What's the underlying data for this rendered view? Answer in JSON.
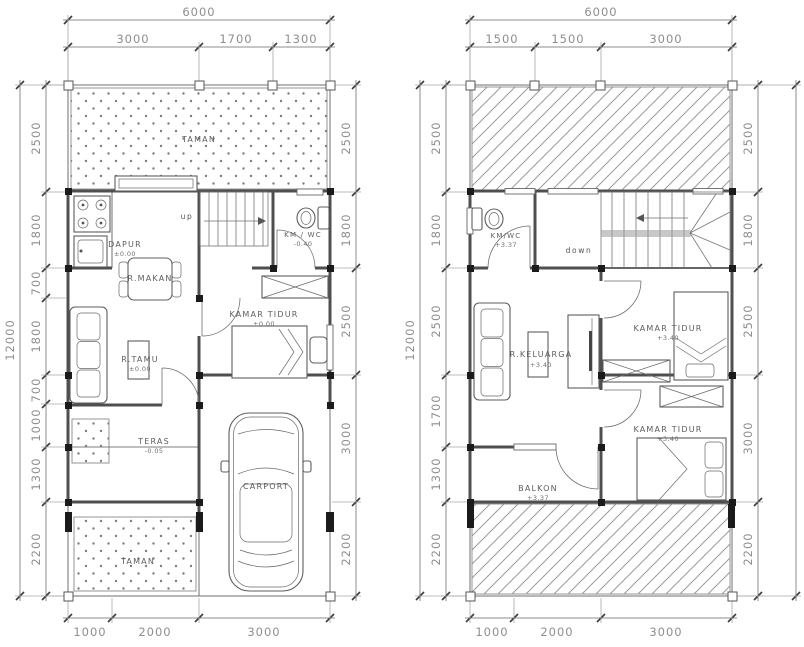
{
  "drawing": {
    "background": "#ffffff",
    "wall_color": "#4f4f4f",
    "dim_text_color": "#8e8e8e",
    "hatch_color": "#9b9b9b",
    "dot_color": "#7d7d7d",
    "column_color": "#1b1b1b"
  },
  "floor1": {
    "dims": {
      "top_total": "6000",
      "top_segments": [
        "3000",
        "1700",
        "1300"
      ],
      "left_total": "12000",
      "left_segments": [
        "2500",
        "1800",
        "700",
        "1800",
        "700",
        "1000",
        "1300",
        "2200"
      ],
      "right_segments": [
        "2500",
        "1800",
        "2500",
        "3000",
        "2200"
      ],
      "bottom_segments": [
        "1000",
        "2000",
        "3000"
      ]
    },
    "labels": {
      "taman_top": "TAMAN",
      "dapur": "DAPUR",
      "dapur_level": "±0.00",
      "stairs": "up",
      "km_wc": "KM / WC",
      "km_wc_level": "-0.40",
      "r_makan": "R.MAKAN",
      "kamar_tidur": "KAMAR TIDUR",
      "kamar_tidur_level": "±0.00",
      "r_tamu": "R.TAMU",
      "r_tamu_level": "±0.00",
      "teras": "TERAS",
      "teras_level": "-0.05",
      "carport": "CARPORT",
      "taman_bottom": "TAMAN"
    }
  },
  "floor2": {
    "dims": {
      "top_total": "6000",
      "top_segments": [
        "1500",
        "1500",
        "3000"
      ],
      "left_total": "12000",
      "left_segments": [
        "2500",
        "1800",
        "2500",
        "1700",
        "1300",
        "2200"
      ],
      "right_segments": [
        "2500",
        "1800",
        "2500",
        "3000",
        "2200"
      ],
      "bottom_segments": [
        "1000",
        "2000",
        "3000"
      ]
    },
    "labels": {
      "km_wc": "KM/WC",
      "km_wc_level": "+3.37",
      "stairs": "down",
      "r_keluarga": "R.KELUARGA",
      "r_keluarga_level": "+3.40",
      "kamar_tidur_1": "KAMAR TIDUR",
      "kamar_tidur_1_level": "+3.40",
      "kamar_tidur_2": "KAMAR TIDUR",
      "kamar_tidur_2_level": "+3.40",
      "balkon": "BALKON",
      "balkon_level": "+3.37"
    }
  }
}
